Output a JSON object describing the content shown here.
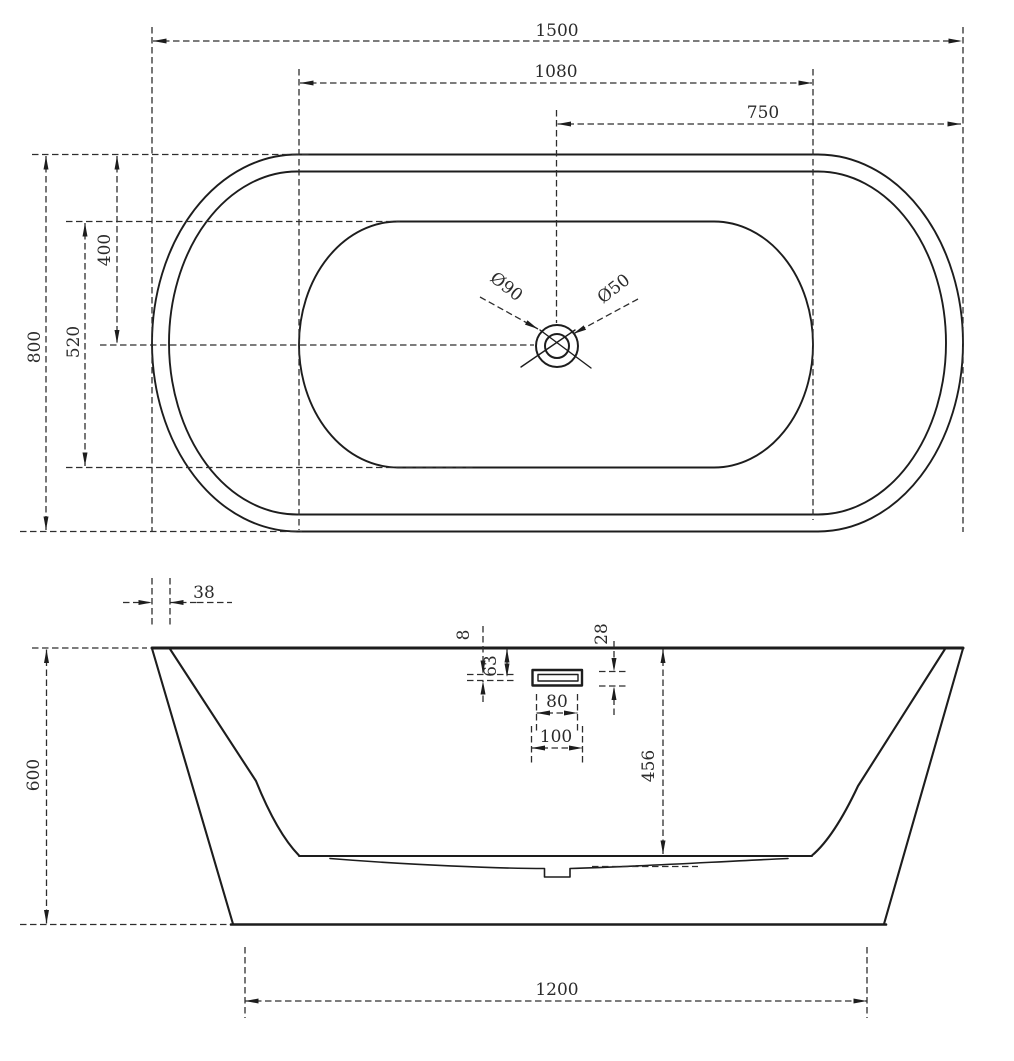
{
  "colors": {
    "background": "#ffffff",
    "line": "#1d1d1d",
    "dashed_line": "#2e2e2e",
    "text": "#2b2b2b"
  },
  "top_view": {
    "dims": {
      "overall_length": "1500",
      "basin_length": "1080",
      "center_to_right": "750",
      "overall_width": "800",
      "basin_width": "520",
      "top_to_center": "400",
      "drain_outer_diameter": "Ø90",
      "drain_inner_diameter": "Ø50"
    }
  },
  "side_view": {
    "dims": {
      "rim_wall_thickness": "38",
      "overall_height": "600",
      "rim_to_slot": "63",
      "slot_height": "8",
      "overflow_height": "28",
      "overflow_inner_width": "80",
      "overflow_outer_width": "100",
      "depth_to_floor": "456",
      "base_length": "1200"
    }
  }
}
